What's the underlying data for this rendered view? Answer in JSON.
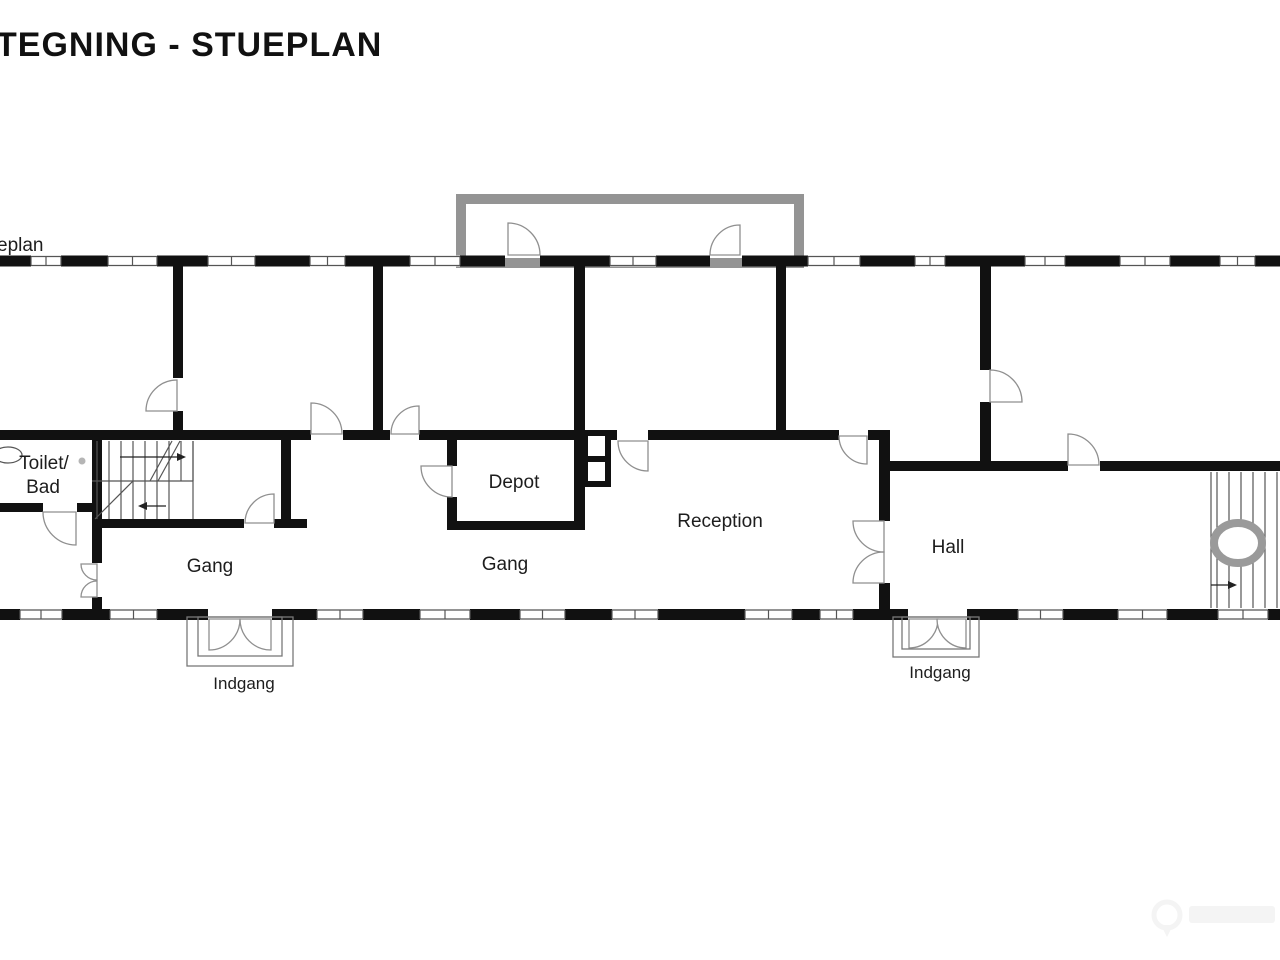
{
  "title": "TEGNING - STUEPLAN",
  "edge_label": "eplan",
  "labels": [
    {
      "text": "Toilet/",
      "x": 44,
      "y": 469,
      "size": 19
    },
    {
      "text": "Bad",
      "x": 43,
      "y": 493,
      "size": 19
    },
    {
      "text": "Gang",
      "x": 210,
      "y": 572,
      "size": 19
    },
    {
      "text": "Depot",
      "x": 514,
      "y": 488,
      "size": 19
    },
    {
      "text": "Gang",
      "x": 505,
      "y": 570,
      "size": 19
    },
    {
      "text": "Reception",
      "x": 720,
      "y": 527,
      "size": 19
    },
    {
      "text": "Hall",
      "x": 948,
      "y": 553,
      "size": 19
    },
    {
      "text": "Indgang",
      "x": 244,
      "y": 689,
      "size": 17
    },
    {
      "text": "Indgang",
      "x": 940,
      "y": 678,
      "size": 17
    }
  ],
  "plan": {
    "canvas": {
      "w": 1280,
      "h": 960
    },
    "colors": {
      "wall": "#111111",
      "thin": "#555555",
      "door": "#8f8f8f",
      "terrace": "#949494",
      "porch": "#787878",
      "ring": "#9a9a9a",
      "watermark": "#f4f4f4"
    },
    "terrace": {
      "x": 461,
      "y": 199,
      "w": 338,
      "h": 64,
      "stroke": 10
    },
    "ext_walls": {
      "top": {
        "y": 255.5,
        "h": 11,
        "blacks": [
          [
            0,
            31
          ],
          [
            61,
            108
          ],
          [
            157,
            208
          ],
          [
            255,
            310
          ],
          [
            345,
            410
          ],
          [
            460,
            505
          ],
          [
            540,
            610
          ],
          [
            656,
            710
          ],
          [
            742,
            808
          ],
          [
            860,
            915
          ],
          [
            945,
            1025
          ],
          [
            1065,
            1120
          ],
          [
            1170,
            1220
          ],
          [
            1255,
            1280
          ]
        ],
        "windows": [
          [
            31,
            61
          ],
          [
            108,
            157
          ],
          [
            208,
            255
          ],
          [
            310,
            345
          ],
          [
            410,
            460
          ],
          [
            610,
            656
          ],
          [
            808,
            860
          ],
          [
            915,
            945
          ],
          [
            1025,
            1065
          ],
          [
            1120,
            1170
          ],
          [
            1220,
            1255
          ]
        ]
      },
      "bottom": {
        "y": 609,
        "h": 11,
        "blacks": [
          [
            0,
            20
          ],
          [
            62,
            110
          ],
          [
            157,
            208
          ],
          [
            272,
            317
          ],
          [
            363,
            420
          ],
          [
            470,
            520
          ],
          [
            565,
            612
          ],
          [
            658,
            745
          ],
          [
            792,
            820
          ],
          [
            853,
            908
          ],
          [
            967,
            1018
          ],
          [
            1063,
            1118
          ],
          [
            1167,
            1218
          ],
          [
            1268,
            1280
          ]
        ],
        "windows": [
          [
            20,
            62
          ],
          [
            110,
            157
          ],
          [
            317,
            363
          ],
          [
            420,
            470
          ],
          [
            520,
            565
          ],
          [
            612,
            658
          ],
          [
            745,
            792
          ],
          [
            820,
            853
          ],
          [
            1018,
            1063
          ],
          [
            1118,
            1167
          ],
          [
            1218,
            1268
          ]
        ]
      }
    },
    "int_walls": {
      "horizontal": [
        {
          "y": 430,
          "h": 10,
          "x1": 0,
          "x2": 311
        },
        {
          "y": 430,
          "h": 10,
          "x1": 343,
          "x2": 390
        },
        {
          "y": 430,
          "h": 10,
          "x1": 419,
          "x2": 617
        },
        {
          "y": 430,
          "h": 10,
          "x1": 648,
          "x2": 839
        },
        {
          "y": 430,
          "h": 10,
          "x1": 868,
          "x2": 890
        },
        {
          "y": 461,
          "h": 10,
          "x1": 886,
          "x2": 1068
        },
        {
          "y": 461,
          "h": 10,
          "x1": 1100,
          "x2": 1280
        },
        {
          "y": 503,
          "h": 9,
          "x1": 0,
          "x2": 43
        },
        {
          "y": 503,
          "h": 9,
          "x1": 77,
          "x2": 102
        },
        {
          "y": 519,
          "h": 9,
          "x1": 92,
          "x2": 244
        },
        {
          "y": 519,
          "h": 9,
          "x1": 274,
          "x2": 307
        },
        {
          "y": 521,
          "h": 9,
          "x1": 447,
          "x2": 585
        }
      ],
      "vertical": [
        {
          "x": 173,
          "w": 10,
          "y1": 266,
          "y2": 378
        },
        {
          "x": 173,
          "w": 10,
          "y1": 411,
          "y2": 436
        },
        {
          "x": 373,
          "w": 10,
          "y1": 266,
          "y2": 436
        },
        {
          "x": 574,
          "w": 11,
          "y1": 266,
          "y2": 530
        },
        {
          "x": 776,
          "w": 10,
          "y1": 266,
          "y2": 436
        },
        {
          "x": 980,
          "w": 11,
          "y1": 266,
          "y2": 370
        },
        {
          "x": 980,
          "w": 11,
          "y1": 402,
          "y2": 468
        },
        {
          "x": 92,
          "w": 10,
          "y1": 436,
          "y2": 563
        },
        {
          "x": 92,
          "w": 10,
          "y1": 597,
          "y2": 615
        },
        {
          "x": 281,
          "w": 10,
          "y1": 438,
          "y2": 521
        },
        {
          "x": 447,
          "w": 10,
          "y1": 436,
          "y2": 466
        },
        {
          "x": 447,
          "w": 10,
          "y1": 497,
          "y2": 527
        },
        {
          "x": 879,
          "w": 11,
          "y1": 430,
          "y2": 521
        },
        {
          "x": 879,
          "w": 11,
          "y1": 583,
          "y2": 612
        }
      ]
    },
    "chimney": {
      "x": 585,
      "y": 433,
      "w": 23,
      "h": 51,
      "stroke": 6,
      "divider_y": 456
    },
    "doors": [
      {
        "name": "terrace-door-left",
        "cx": 508,
        "cy": 255,
        "r": 32,
        "a1": -90,
        "a2": 0
      },
      {
        "name": "terrace-door-right",
        "cx": 740,
        "cy": 255,
        "r": 30,
        "a1": 180,
        "a2": 270
      },
      {
        "name": "door-room1-corridor",
        "cx": 311,
        "cy": 434,
        "r": 31,
        "a1": -90,
        "a2": 0
      },
      {
        "name": "door-room2-corridor",
        "cx": 419,
        "cy": 434,
        "r": 28,
        "a1": 180,
        "a2": 270
      },
      {
        "name": "door-depot-corner",
        "cx": 648,
        "cy": 441,
        "r": 30,
        "a1": 90,
        "a2": 180
      },
      {
        "name": "door-reception-top",
        "cx": 867,
        "cy": 436,
        "r": 28,
        "a1": 90,
        "a2": 180
      },
      {
        "name": "door-hall-top",
        "cx": 1068,
        "cy": 465,
        "r": 31,
        "a1": -90,
        "a2": 0
      },
      {
        "name": "door-right-room",
        "cx": 990,
        "cy": 402,
        "r": 32,
        "a1": -90,
        "a2": 0
      },
      {
        "name": "door-stair-room",
        "cx": 177,
        "cy": 411,
        "r": 31,
        "a1": -90,
        "a2": -180
      },
      {
        "name": "door-toilet",
        "cx": 76,
        "cy": 512,
        "r": 33,
        "a1": 180,
        "a2": 90
      },
      {
        "name": "door-stair-corridor",
        "cx": 274,
        "cy": 523,
        "r": 29,
        "a1": 180,
        "a2": 270
      },
      {
        "name": "door-left-small-a",
        "cx": 97,
        "cy": 564,
        "r": 16,
        "a1": 180,
        "a2": 90
      },
      {
        "name": "door-left-small-b",
        "cx": 97,
        "cy": 597,
        "r": 16,
        "a1": 180,
        "a2": 270
      },
      {
        "name": "door-depot-left",
        "cx": 452,
        "cy": 466,
        "r": 31,
        "a1": 180,
        "a2": 90
      },
      {
        "name": "reception-double-top",
        "cx": 884,
        "cy": 521,
        "r": 31,
        "a1": 180,
        "a2": 90
      },
      {
        "name": "reception-double-bottom",
        "cx": 884,
        "cy": 583,
        "r": 31,
        "a1": 180,
        "a2": 270
      },
      {
        "name": "entrance-left-leaf-a",
        "cx": 209,
        "cy": 619,
        "r": 31,
        "a1": 90,
        "a2": 0
      },
      {
        "name": "entrance-left-leaf-b",
        "cx": 271,
        "cy": 619,
        "r": 31,
        "a1": 90,
        "a2": 180
      },
      {
        "name": "entrance-right-leaf-a",
        "cx": 909,
        "cy": 619,
        "r": 29,
        "a1": 90,
        "a2": 0
      },
      {
        "name": "entrance-right-leaf-b",
        "cx": 966,
        "cy": 619,
        "r": 29,
        "a1": 90,
        "a2": 180
      }
    ],
    "porches": [
      {
        "x": 187,
        "y": 617,
        "w": 106,
        "h": 49
      },
      {
        "x": 198,
        "y": 617,
        "w": 84,
        "h": 39
      },
      {
        "x": 893,
        "y": 617,
        "w": 86,
        "h": 40
      },
      {
        "x": 902,
        "y": 617,
        "w": 68,
        "h": 32
      }
    ],
    "stairs": {
      "left": {
        "upper_treads": {
          "x1": 97,
          "x2": 193,
          "step": 12,
          "y1": 441,
          "y2": 481
        },
        "lower_treads": {
          "x1": 97,
          "x2": 169,
          "step": 12,
          "y1": 481,
          "y2": 519
        },
        "mid_line": {
          "x1": 92,
          "x2": 193,
          "y": 481
        },
        "right_edge": {
          "x": 193,
          "y1": 441,
          "y2": 519
        },
        "diagonals": [
          [
            150,
            481,
            172,
            441
          ],
          [
            158,
            481,
            180,
            441
          ],
          [
            95,
            519,
            133,
            481
          ]
        ],
        "arrows": [
          {
            "x1": 120,
            "x2": 186,
            "y": 457
          },
          {
            "x1": 166,
            "x2": 138,
            "y": 506
          }
        ]
      },
      "right": {
        "treads": {
          "x1": 1217,
          "x2": 1277,
          "step": 12,
          "y1": 472,
          "y2": 608
        },
        "left_edge": {
          "x": 1211,
          "y1": 472,
          "y2": 608
        },
        "ring": {
          "cx": 1238,
          "cy": 543,
          "rx": 24,
          "ry": 20,
          "stroke": 8
        },
        "arrow": {
          "x1": 1211,
          "x2": 1237,
          "y": 585
        }
      }
    },
    "sink": {
      "cx": 8,
      "cy": 455,
      "rx": 14,
      "ry": 8
    },
    "dot": {
      "cx": 82,
      "cy": 461,
      "r": 3.5
    },
    "watermark": {
      "cx": 1167,
      "cy": 915,
      "r": 13
    }
  }
}
